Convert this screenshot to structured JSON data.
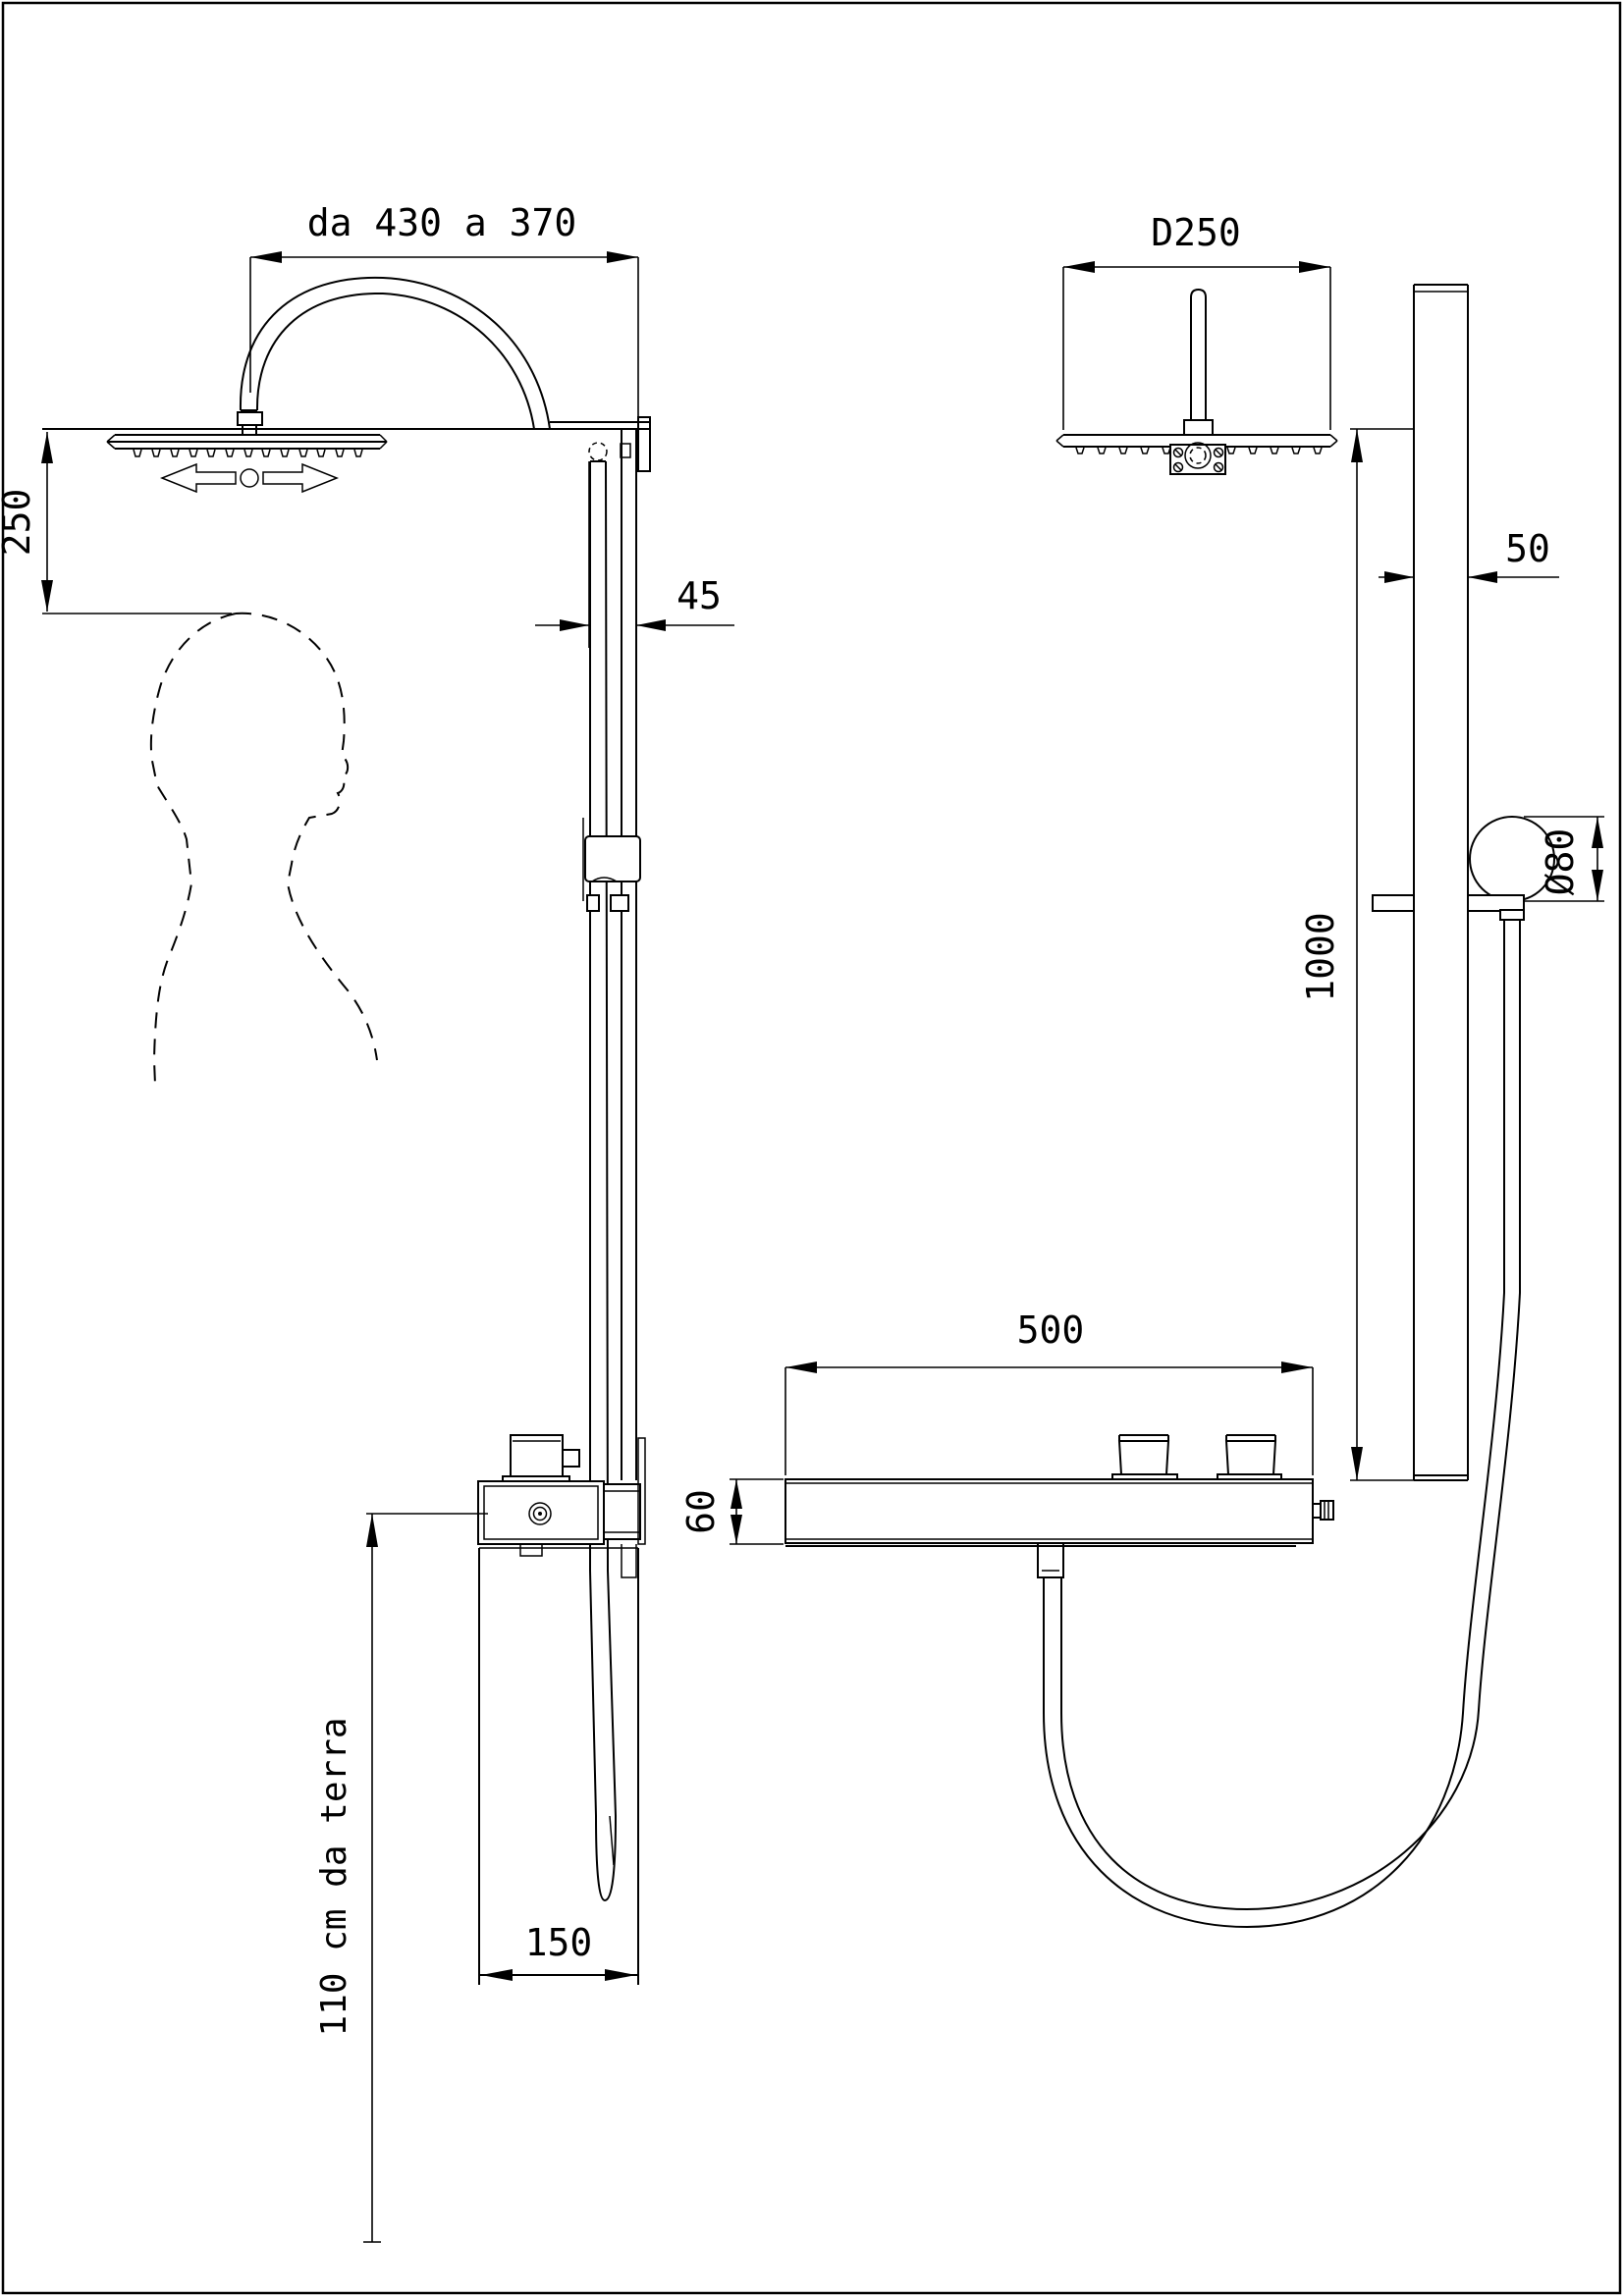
{
  "page": {
    "background": "#ffffff",
    "line_color": "#000000"
  },
  "drawing": {
    "type": "shower-column-dimensional-drawing",
    "views": {
      "side": "side-elevation-with-user-silhouette",
      "front": "front-elevation"
    }
  },
  "dimensions": {
    "arm_reach": "da 430 a 370",
    "head_clearance": "250",
    "column_depth": "45",
    "showerhead_diameter": "D250",
    "column_width": "50",
    "holder_diameter": "Ø80",
    "slide_bar_length": "1000",
    "mixer_width": "500",
    "mixer_height": "60",
    "panel_width": "150",
    "installation_height": "110 cm da terra"
  }
}
